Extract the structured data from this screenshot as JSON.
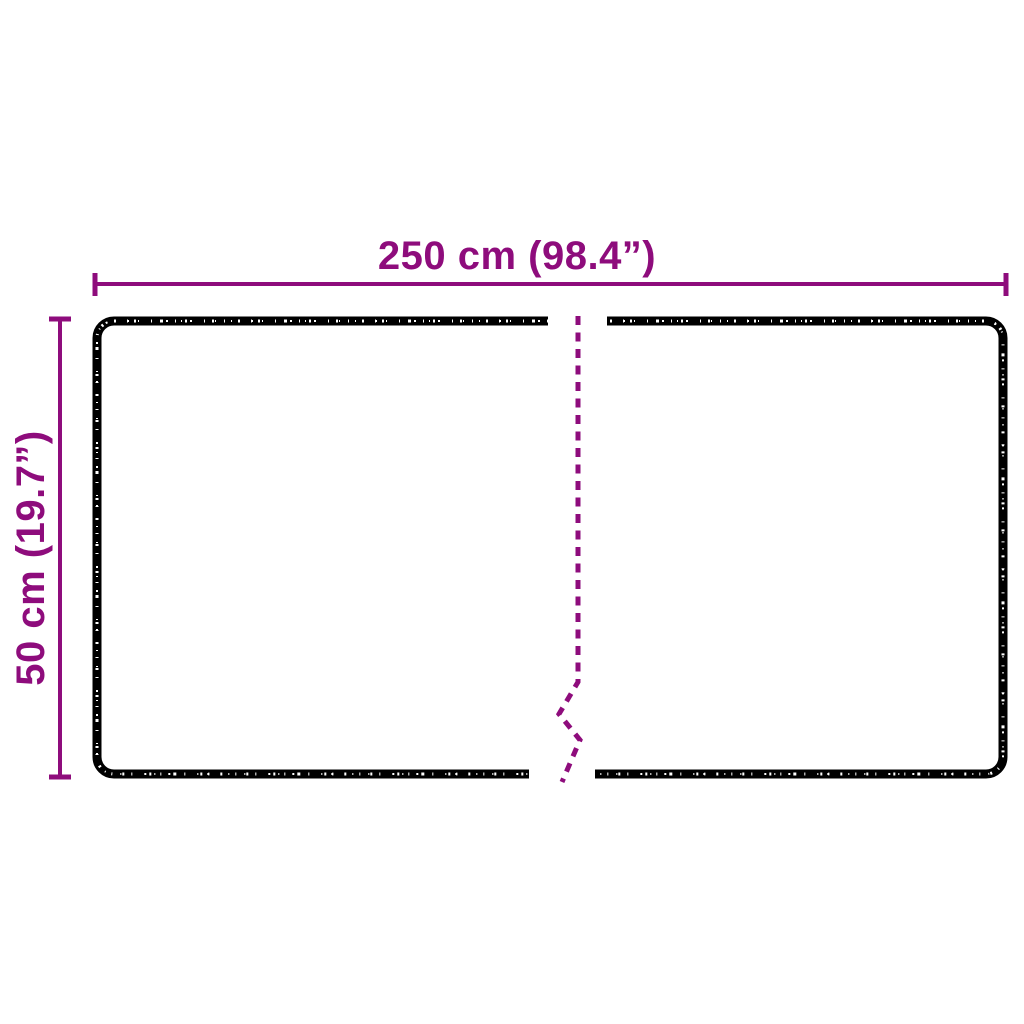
{
  "figure": {
    "kind": "product-dimension-diagram",
    "width_label": "250 cm (98.4”)",
    "height_label": "50 cm (19.7”)",
    "colors": {
      "dimension_accent": "#8e0c7c",
      "outline_black": "#000000",
      "background": "#ffffff",
      "speckle": "#ffffff"
    }
  }
}
